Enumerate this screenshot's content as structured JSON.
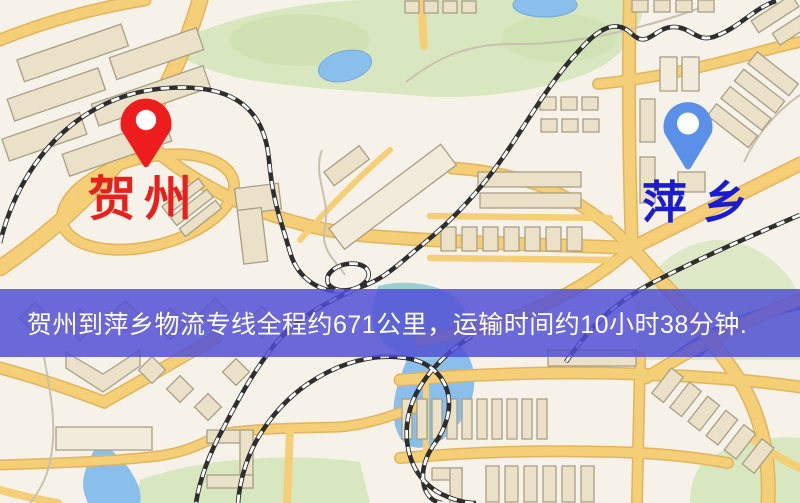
{
  "markers": {
    "origin": {
      "label": "贺州",
      "pin_icon": "red-map-pin",
      "pin_color": "#ee1d1d",
      "label_color": "#e8201c"
    },
    "destination": {
      "label": "萍乡",
      "pin_icon": "blue-map-pin",
      "pin_color": "#5b90e9",
      "label_color": "#1b1bd0"
    }
  },
  "banner": {
    "text": "贺州到萍乡物流专线全程约671公里，运输时间约10小时38分钟.",
    "background_color": "#504fd7",
    "text_color": "#ffffff"
  },
  "route_summary": {
    "origin": "贺州",
    "destination": "萍乡",
    "distance": "约671公里",
    "duration": "约10小时38分钟"
  },
  "map_colors": {
    "background": "#f7f2e9",
    "road": "#f4cf78",
    "road_edge": "#e2b45c",
    "park_green": "#d8e7bf",
    "water_blue": "#8abfec",
    "railway_dark": "#2e2e2e",
    "building_beige": "#eae1c8"
  }
}
